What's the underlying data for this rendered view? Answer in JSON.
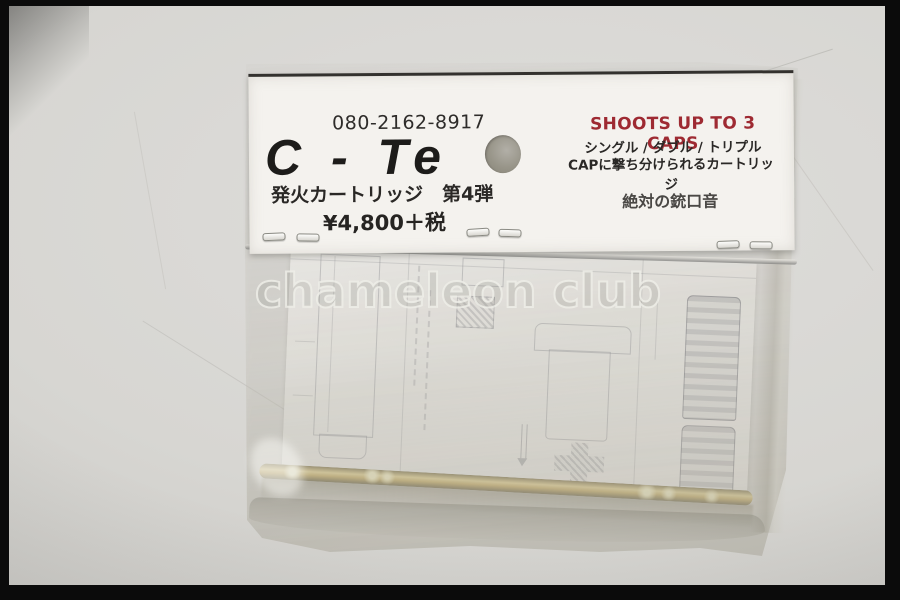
{
  "photo": {
    "watermark_text": "chameleon club",
    "background_color": "#d7d6d2",
    "frame_color": "#0b0b0b"
  },
  "header_card": {
    "phone": "080-2162-8917",
    "brand": "C - Te",
    "product_line": "発火カートリッジ　第4弾",
    "price": "¥4,800＋税",
    "claim": "SHOOTS UP TO 3 CAPS",
    "claim_color": "#9e2a32",
    "modes": "シングル / ダブル / トリプル",
    "cap_line": "CAPに撃ち分けられるカートリッジ",
    "tagline": "絶対の銃口音"
  },
  "package": {
    "cartridge_color": "#c9a84c"
  }
}
